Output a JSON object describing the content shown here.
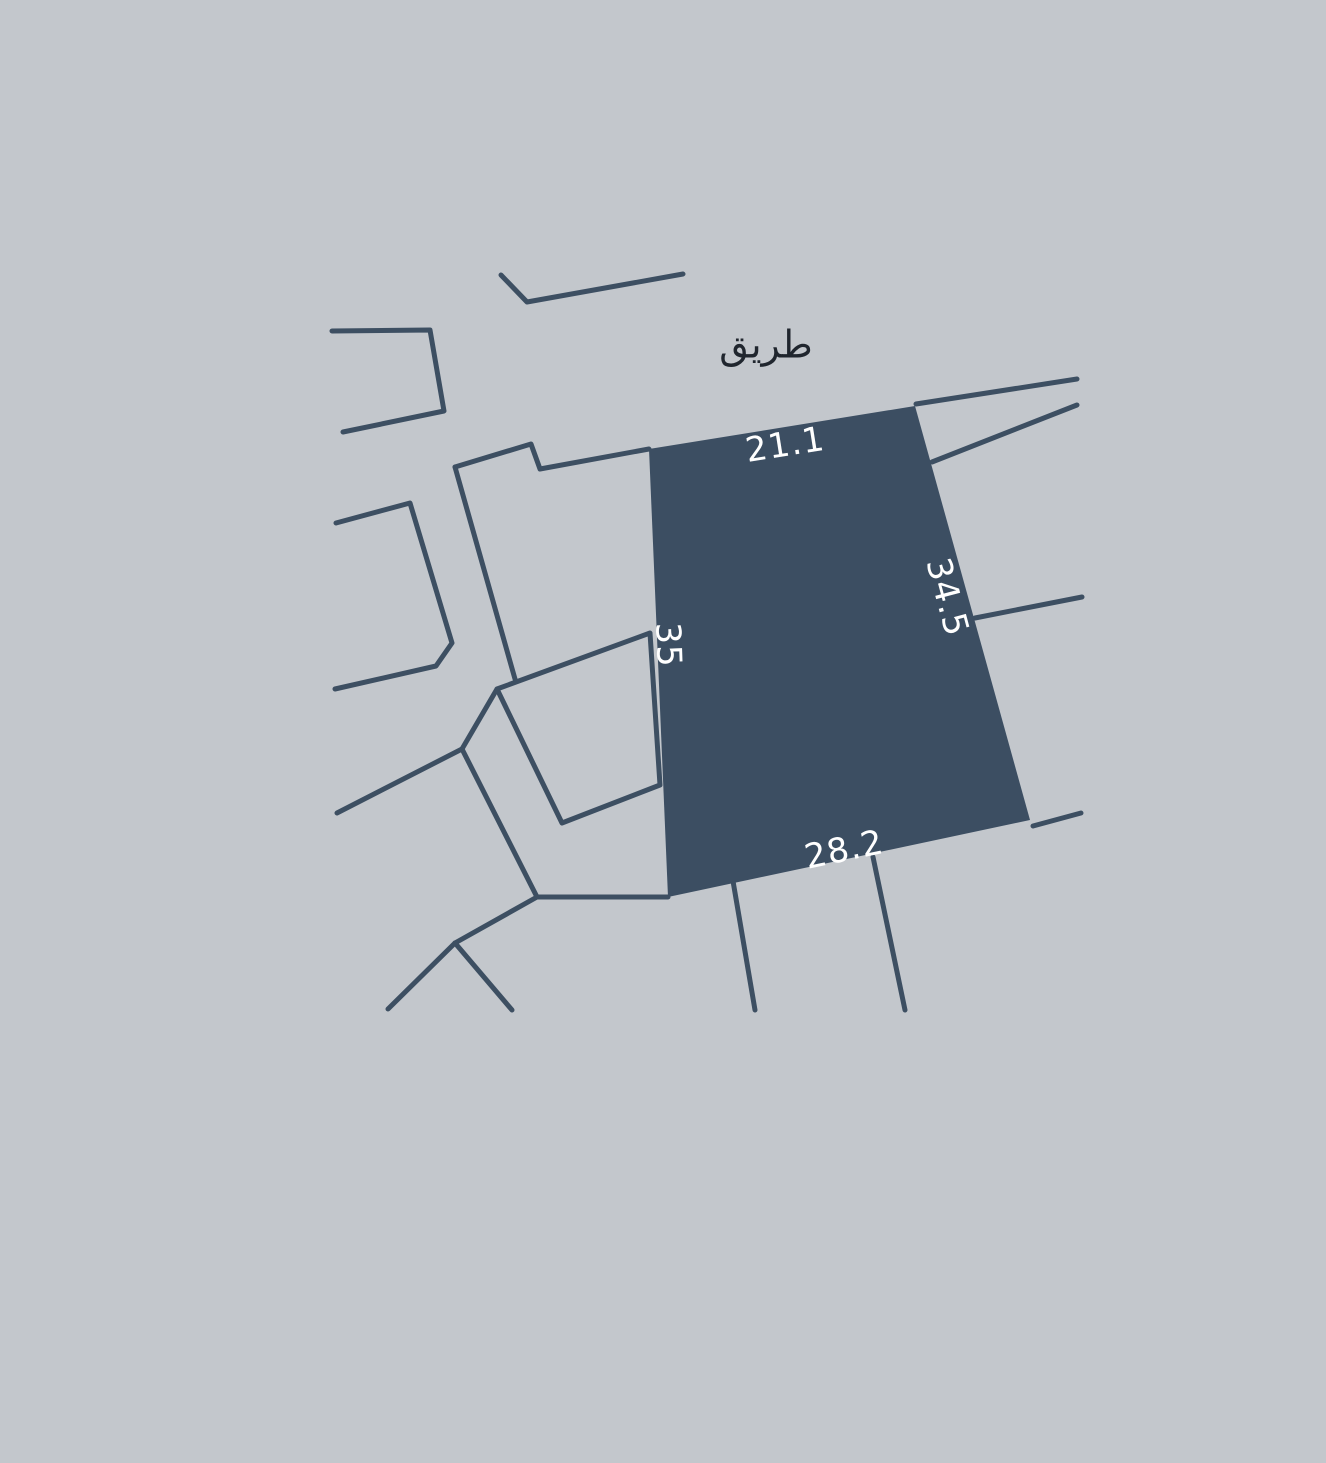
{
  "map": {
    "background_color": "#c3c7cc",
    "line_color": "#3d4f62",
    "line_width": 5,
    "road_label": {
      "text": "طريق",
      "x": 766,
      "y": 344,
      "rotate": 0,
      "color": "#20262e"
    },
    "parcel": {
      "fill_color": "#3c4e62",
      "points": [
        [
          649,
          449
        ],
        [
          915,
          406
        ],
        [
          1030,
          820
        ],
        [
          668,
          897
        ]
      ],
      "dimension_label_color": "#ffffff",
      "dimensions": [
        {
          "side": "top",
          "value": "21.1",
          "x": 785,
          "y": 444,
          "rotate": -9
        },
        {
          "side": "right",
          "value": "34.5",
          "x": 948,
          "y": 597,
          "rotate": 75
        },
        {
          "side": "left",
          "value": "35",
          "x": 669,
          "y": 645,
          "rotate": 88
        },
        {
          "side": "bottom",
          "value": "28.2",
          "x": 844,
          "y": 849,
          "rotate": -12
        }
      ]
    },
    "boundary_lines": [
      {
        "name": "boundary-line-north-chevron",
        "points": [
          [
            501,
            275
          ],
          [
            527,
            302
          ],
          [
            683,
            274
          ]
        ]
      },
      {
        "name": "boundary-line-northwest-lot",
        "points": [
          [
            332,
            331
          ],
          [
            430,
            330
          ],
          [
            444,
            411
          ],
          [
            343,
            432
          ]
        ]
      },
      {
        "name": "boundary-line-west-lot",
        "points": [
          [
            336,
            523
          ],
          [
            410,
            503
          ],
          [
            452,
            643
          ],
          [
            436,
            666
          ],
          [
            335,
            689
          ]
        ]
      },
      {
        "name": "boundary-line-step-to-parcel",
        "points": [
          [
            455,
            467
          ],
          [
            531,
            444
          ],
          [
            540,
            469
          ],
          [
            649,
            449
          ]
        ]
      },
      {
        "name": "boundary-line-west-road-edge",
        "points": [
          [
            455,
            467
          ],
          [
            515,
            679
          ]
        ]
      },
      {
        "name": "boundary-line-adjacent-lot",
        "points": [
          [
            497,
            689
          ],
          [
            650,
            633
          ],
          [
            660,
            785
          ],
          [
            562,
            823
          ]
        ],
        "closed": true
      },
      {
        "name": "boundary-line-southwest-1",
        "points": [
          [
            337,
            813
          ],
          [
            462,
            749
          ]
        ]
      },
      {
        "name": "boundary-line-southwest-2",
        "points": [
          [
            462,
            749
          ],
          [
            497,
            689
          ]
        ]
      },
      {
        "name": "boundary-line-southwest-3",
        "points": [
          [
            462,
            749
          ],
          [
            537,
            897
          ]
        ]
      },
      {
        "name": "boundary-line-south-to-corner",
        "points": [
          [
            537,
            897
          ],
          [
            668,
            897
          ]
        ]
      },
      {
        "name": "boundary-line-southwest-4",
        "points": [
          [
            537,
            897
          ],
          [
            455,
            943
          ]
        ]
      },
      {
        "name": "boundary-line-southwest-5",
        "points": [
          [
            455,
            943
          ],
          [
            388,
            1009
          ]
        ]
      },
      {
        "name": "boundary-line-southwest-6",
        "points": [
          [
            455,
            943
          ],
          [
            512,
            1010
          ]
        ]
      },
      {
        "name": "boundary-line-south-lot-1",
        "points": [
          [
            733,
            881
          ],
          [
            755,
            1010
          ]
        ]
      },
      {
        "name": "boundary-line-south-lot-2",
        "points": [
          [
            873,
            857
          ],
          [
            905,
            1010
          ]
        ]
      },
      {
        "name": "boundary-line-southeast",
        "points": [
          [
            1033,
            826
          ],
          [
            1081,
            813
          ]
        ]
      },
      {
        "name": "boundary-line-northeast-1",
        "points": [
          [
            916,
            404
          ],
          [
            1077,
            379
          ]
        ]
      },
      {
        "name": "boundary-line-northeast-2",
        "points": [
          [
            932,
            462
          ],
          [
            1077,
            405
          ]
        ]
      },
      {
        "name": "boundary-line-east",
        "points": [
          [
            975,
            618
          ],
          [
            1082,
            597
          ]
        ]
      }
    ]
  }
}
